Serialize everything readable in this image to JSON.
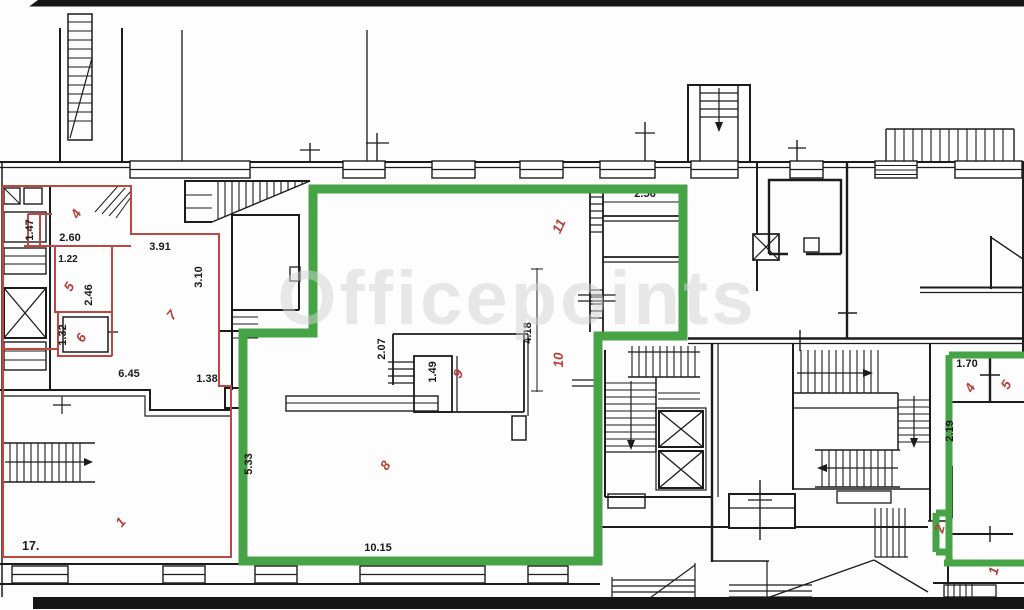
{
  "watermark": "Officepoints",
  "colors": {
    "wall": "#1c1c1c",
    "green_outline": "#46a446",
    "red_outline": "#c0473f",
    "room_label": "#b5403a",
    "dimension": "#1a1a1a",
    "watermark_gray": "#d2d2d2"
  },
  "red_area": {
    "rooms": {
      "r4": "4",
      "r5": "5",
      "r6": "6",
      "r7": "7",
      "r1": "1",
      "r17": "17."
    },
    "dims": {
      "d147": "1.47",
      "d260": "2.60",
      "d122": "1.22",
      "d246": "2.46",
      "d132": "1.32",
      "d391": "3.91",
      "d310": "3.10",
      "d645": "6.45",
      "d138": "1.38"
    }
  },
  "green_area": {
    "rooms": {
      "r8": "8",
      "r9": "9",
      "r10": "10",
      "r11": "11"
    },
    "dims": {
      "d256": "2.56",
      "d207": "2.07",
      "d149": "1.49",
      "d418": "4.18",
      "d533": "5.33",
      "d1015": "10.15"
    }
  },
  "green_area_right": {
    "rooms": {
      "r4": "4",
      "r5": "5",
      "r2": "2",
      "r1": "1"
    },
    "dims": {
      "d170": "1.70",
      "d219": "2.19"
    }
  }
}
